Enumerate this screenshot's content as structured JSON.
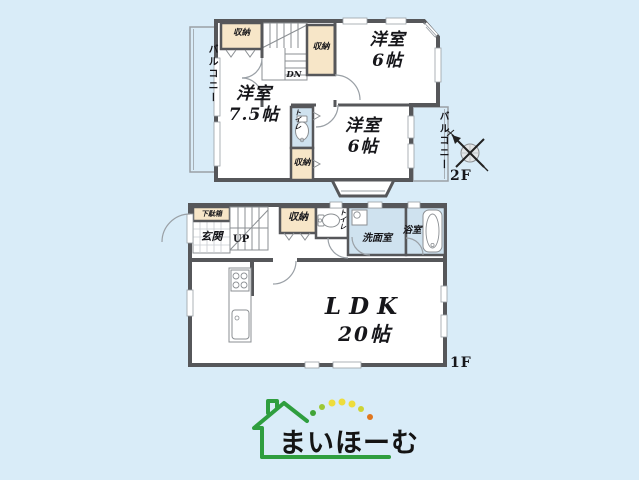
{
  "floor2": {
    "label": "2F",
    "stairs_label": "DN",
    "balcony_left": "バルコニー",
    "balcony_right": "バルコニー",
    "closet_top_left": "収納",
    "closet_center": "収納",
    "closet_lower": "収納",
    "toilet": "トイレ",
    "room_top": {
      "name": "洋室",
      "size": "6帖"
    },
    "room_left": {
      "name": "洋室",
      "size": "7.5帖"
    },
    "room_bottom": {
      "name": "洋室",
      "size": "6帖"
    }
  },
  "floor1": {
    "label": "1F",
    "stairs_label": "UP",
    "shoe_cabinet": "下駄箱",
    "entrance": "玄関",
    "closet": "収納",
    "toilet": "トイレ",
    "washroom": "洗面室",
    "bathroom": "浴室",
    "ldk": {
      "name": "LDK",
      "size": "20帖"
    }
  },
  "logo": {
    "text": "まいほーむ"
  },
  "icons": {
    "compass": "north-compass-icon",
    "toilet": "toilet-icon",
    "bathtub": "bathtub-icon",
    "sink": "sink-icon",
    "stove": "stove-icon"
  },
  "colors": {
    "background": "#d9ecf8",
    "wall": "#56575a",
    "storage_fill": "#f7e6c8",
    "wet_area_fill": "#cfe2ef",
    "logo_green": "#2f9e3f",
    "dot_yellow": "#eedd3c",
    "dot_green": "#41a438",
    "dot_orange": "#e0761e"
  }
}
